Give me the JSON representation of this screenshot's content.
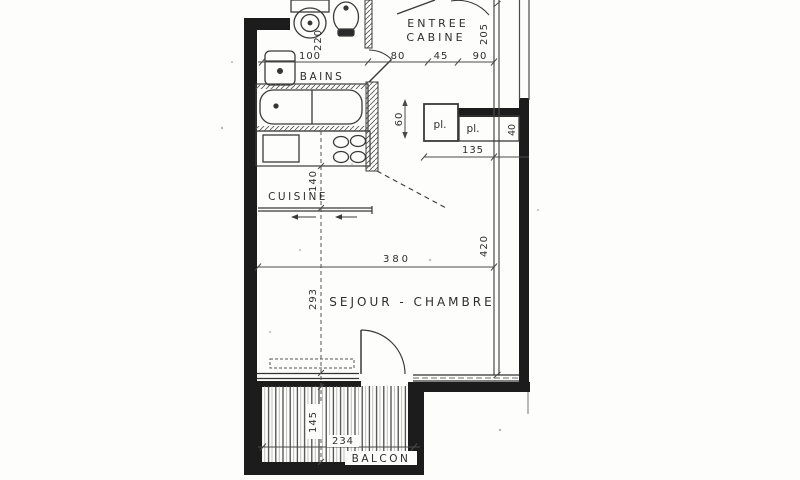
{
  "plan": {
    "labels": {
      "entree_l1": "ENTREE",
      "entree_l2": "CABINE",
      "bains": "BAINS",
      "cuisine": "CUISINE",
      "sejour": "SEJOUR - CHAMBRE",
      "balcon": "BALCON",
      "placard_left": "pl.",
      "placard_right": "pl."
    },
    "dims": {
      "bath_width": "100",
      "entree_a": "80",
      "entree_b": "45",
      "entree_c": "90",
      "entree_depth": "205",
      "wc_width": "220",
      "placard_depth": "60",
      "placard_right_depth": "40",
      "placard_width": "135",
      "cuisine_depth": "140",
      "sejour_width": "380",
      "east_length": "420",
      "sejour_depth": "293",
      "balcon_depth": "145",
      "balcon_width": "234"
    },
    "colors": {
      "paper": "#fdfdfb",
      "wall": "#1c1c1c",
      "ink": "#3a3a3a"
    }
  }
}
